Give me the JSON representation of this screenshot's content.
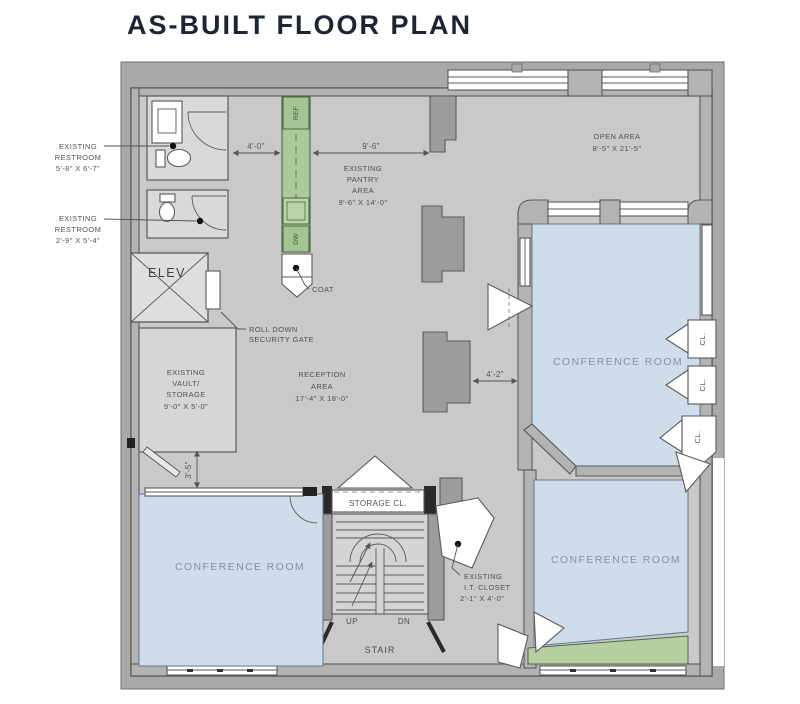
{
  "title": "AS-BUILT FLOOR PLAN",
  "colors": {
    "title": "#1d2433",
    "margin": "#a9a9a9",
    "floor": "#c9c9c9",
    "wall": "#b3b3b3",
    "conference_fill": "#cfdce9",
    "cabinet_green": "#abc99a",
    "planter_green": "#b6cfa2",
    "label": "#525252",
    "conference_label": "#8494a6"
  },
  "rooms": {
    "restroom1": {
      "line1": "EXISTING",
      "line2": "RESTROOM",
      "dims": "5'-8\" X 6'-7\""
    },
    "restroom2": {
      "line1": "EXISTING",
      "line2": "RESTROOM",
      "dims": "2'-9\" X 5'-4\""
    },
    "pantry": {
      "line1": "EXISTING",
      "line2": "PANTRY",
      "line3": "AREA",
      "dims": "9'-6\" X 14'-0\""
    },
    "open_area": {
      "line1": "OPEN AREA",
      "dims": "8'-5\" X 21'-5\""
    },
    "elevator": {
      "label": "ELEV"
    },
    "coat": {
      "label": "COAT"
    },
    "security_gate": {
      "line1": "ROLL DOWN",
      "line2": "SECURITY GATE"
    },
    "vault": {
      "line1": "EXISTING",
      "line2": "VAULT/",
      "line3": "STORAGE",
      "dims": "9'-0\" X 5'-0\""
    },
    "reception": {
      "line1": "RECEPTION",
      "line2": "AREA",
      "dims": "17'-4\" X 18'-0\""
    },
    "conference_room": {
      "label": "CONFERENCE ROOM"
    },
    "closet": {
      "label": "CL."
    },
    "storage_closet": {
      "label": "STORAGE CL."
    },
    "stair": {
      "label": "STAIR",
      "up": "UP",
      "dn": "DN"
    },
    "it_closet": {
      "line1": "EXISTING",
      "line2": "I.T. CLOSET",
      "dims": "2'-1\" X 4'-0\""
    },
    "ref": {
      "label": "REF"
    },
    "dw": {
      "label": "DW"
    }
  },
  "dimensions": {
    "restroom_to_pantry": "4'-0\"",
    "pantry_width": "9'-6\"",
    "column_gap": "4'-2\"",
    "vault_door": "3'-5\""
  }
}
